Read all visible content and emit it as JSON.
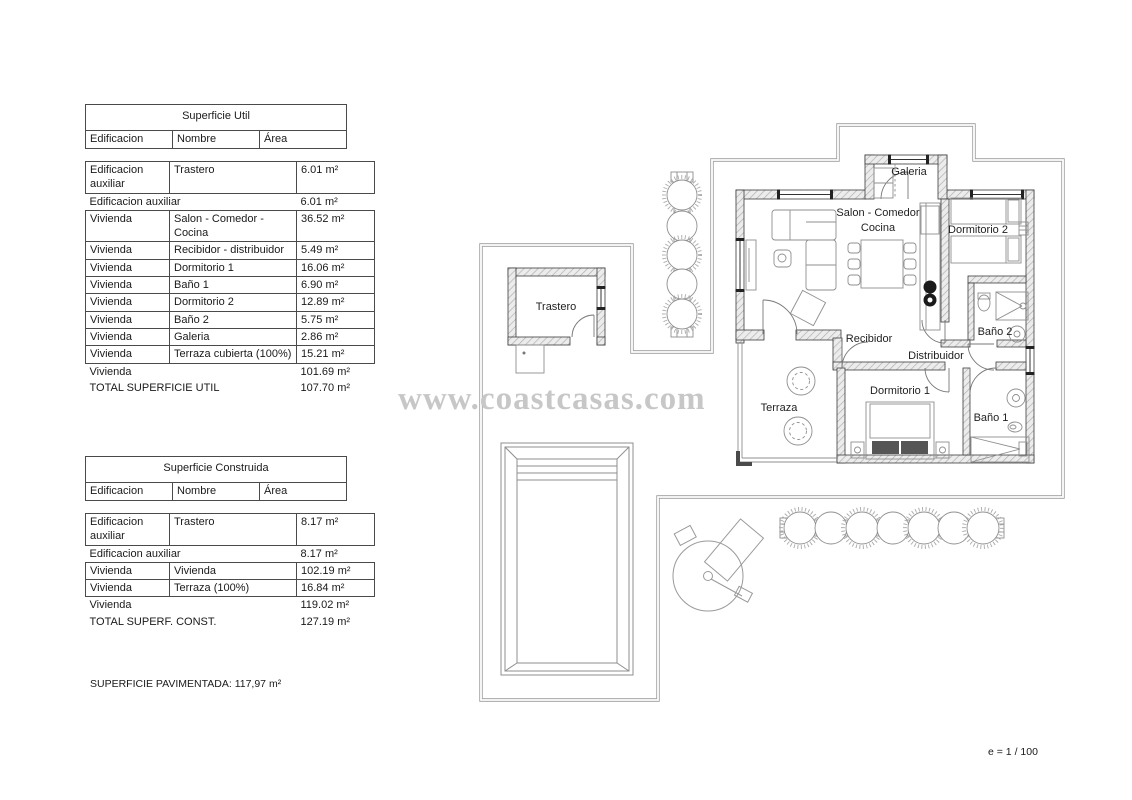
{
  "page": {
    "watermark_text": "www.coastcasas.com",
    "scale_note": "e = 1 / 100",
    "paved_note": "SUPERFICIE PAVIMENTADA: 117,97 m²"
  },
  "tables": {
    "util": {
      "title": "Superficie Util",
      "h1": "Edificacion",
      "h2": "Nombre",
      "h3": "Área",
      "r1": {
        "c1": "Edificacion auxiliar",
        "c2": "Trastero",
        "c3": "6.01 m²"
      },
      "s1": {
        "c1": "Edificacion auxiliar",
        "c3": "6.01 m²"
      },
      "r2": {
        "c1": "Vivienda",
        "c2": "Salon - Comedor - Cocina",
        "c3": "36.52 m²"
      },
      "r3": {
        "c1": "Vivienda",
        "c2": "Recibidor - distribuidor",
        "c3": "5.49 m²"
      },
      "r4": {
        "c1": "Vivienda",
        "c2": "Dormitorio 1",
        "c3": "16.06 m²"
      },
      "r5": {
        "c1": "Vivienda",
        "c2": "Baño 1",
        "c3": "6.90 m²"
      },
      "r6": {
        "c1": "Vivienda",
        "c2": "Dormitorio 2",
        "c3": "12.89 m²"
      },
      "r7": {
        "c1": "Vivienda",
        "c2": "Baño 2",
        "c3": "5.75 m²"
      },
      "r8": {
        "c1": "Vivienda",
        "c2": "Galeria",
        "c3": "2.86 m²"
      },
      "r9": {
        "c1": "Vivienda",
        "c2": "Terraza cubierta (100%)",
        "c3": "15.21 m²"
      },
      "s2": {
        "c1": "Vivienda",
        "c3": "101.69 m²"
      },
      "total": {
        "c1": "TOTAL SUPERFICIE UTIL",
        "c3": "107.70 m²"
      }
    },
    "construida": {
      "title": "Superficie Construida",
      "h1": "Edificacion",
      "h2": "Nombre",
      "h3": "Área",
      "r1": {
        "c1": "Edificacion auxiliar",
        "c2": "Trastero",
        "c3": "8.17 m²"
      },
      "s1": {
        "c1": "Edificacion auxiliar",
        "c3": "8.17 m²"
      },
      "r2": {
        "c1": "Vivienda",
        "c2": "Vivienda",
        "c3": "102.19 m²"
      },
      "r3": {
        "c1": "Vivienda",
        "c2": "Terraza (100%)",
        "c3": "16.84 m²"
      },
      "s2": {
        "c1": "Vivienda",
        "c3": "119.02 m²"
      },
      "total": {
        "c1": "TOTAL SUPERF. CONST.",
        "c3": "127.19 m²"
      }
    }
  },
  "plan": {
    "labels": {
      "galeria": "Galeria",
      "salon_line1": "Salon - Comedor",
      "salon_line2": "Cocina",
      "dormitorio2": "Dormitorio 2",
      "recibidor": "Recibidor",
      "distribuidor": "Distribuidor",
      "bano2": "Baño 2",
      "terraza": "Terraza",
      "dormitorio1": "Dormitorio 1",
      "bano1": "Baño 1",
      "trastero": "Trastero"
    },
    "colors": {
      "wall_edge": "#3c3c3c",
      "wall_hatch": "#bdbdbd",
      "boundary_line": "#9a9a9a",
      "furniture_line": "#8f8f8f",
      "label_text": "#1f1f1f",
      "watermark": "#c7c7c7"
    }
  }
}
